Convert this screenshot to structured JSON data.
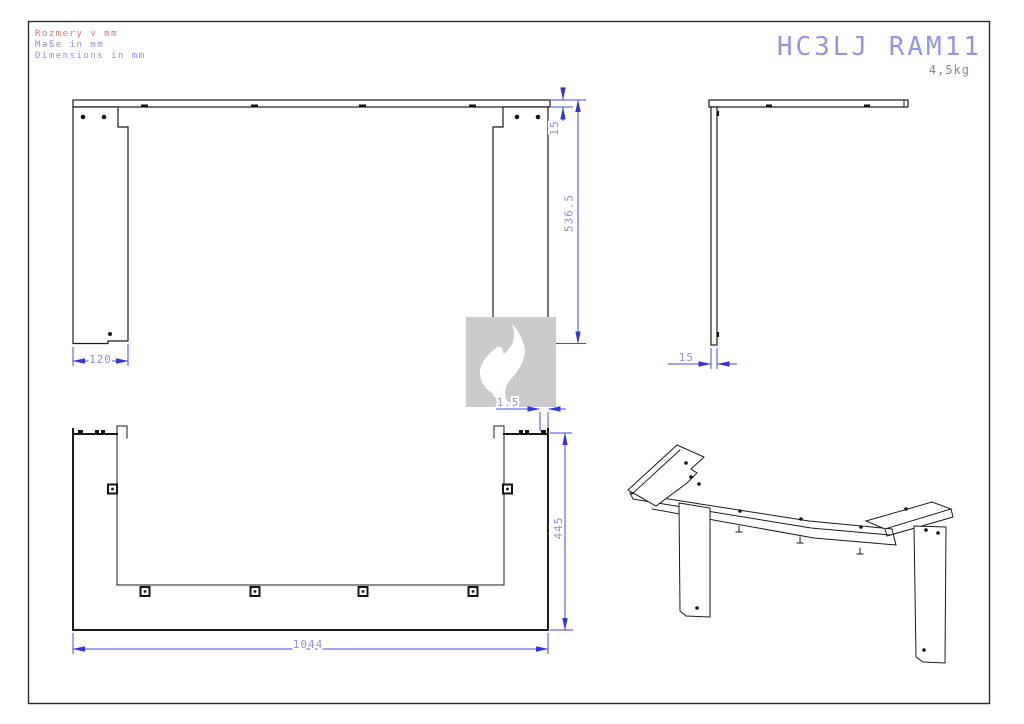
{
  "header": {
    "notes": [
      "Rozmery v mm",
      "Maße in mm",
      "Dimensions in mm"
    ],
    "model": "HC3LJ RAM11",
    "weight": "4,5kg"
  },
  "dimensions": {
    "front": {
      "rail_height": "15",
      "total_height": "536.5",
      "left_leg_width": "120",
      "right_leg_width": "120"
    },
    "side": {
      "panel_thickness": "15"
    },
    "bottom": {
      "edge_offset": "1.5",
      "depth": "445",
      "overall_width": "1044"
    }
  },
  "colors": {
    "outline": "#1b1b1b",
    "dimension_line": "#4747dd",
    "dimension_text": "#8f8fe4",
    "note_highlight": "#c17d7d",
    "note_normal": "#8f8fe4",
    "title": "#9595e6",
    "weight_text": "#8585ac",
    "watermark_background": "#cbcbcb",
    "watermark_flame": "#ffffff"
  },
  "watermark": {
    "icon": "flame"
  }
}
